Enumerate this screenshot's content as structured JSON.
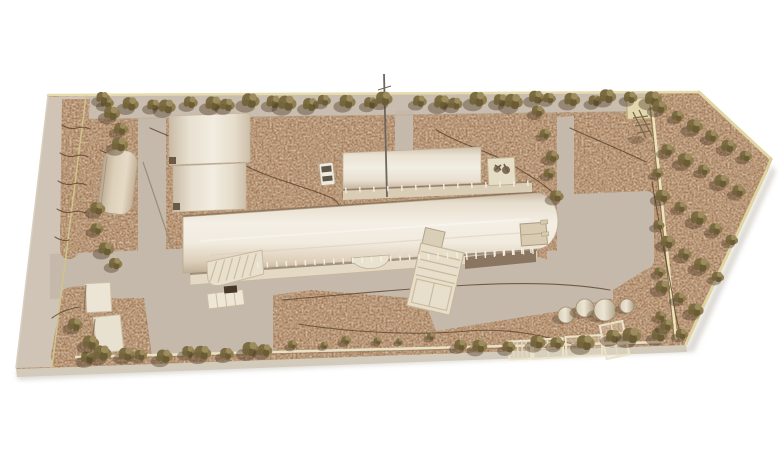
{
  "meta": {
    "title": "Aerial photograph of an architectural site scale model",
    "model_type": "physical scale model: speckled cork site base, pale wood buildings, foam foliage trees",
    "background": "#ffffff"
  },
  "palette": {
    "cork": "#a6764d",
    "pavement": "#c5b9ab",
    "outer_road": "#cfc4b5",
    "north_strip": "#c8bdae",
    "building_cream": "#f2ede1",
    "building_shadow": "#c9baa4",
    "wood_edge": "#e6dcae",
    "tree_olive": "#8a7a4e",
    "tree_dark": "#5f4f2e",
    "contour_line": "#5c432b"
  },
  "site": {
    "shape": "elongated polygon pointed at the right end, bordered by thin wood edge strips",
    "buildings_count": 8,
    "tree_count_approx": 95
  },
  "trees": {
    "rows": [
      [
        112,
        105,
        388,
        101,
        15,
        1.05,
        1.5
      ],
      [
        420,
        102,
        650,
        97,
        13,
        1.0,
        1.5
      ],
      [
        106,
        100,
        122,
        142,
        4,
        1.0,
        1.35
      ],
      [
        96,
        210,
        113,
        266,
        4,
        1.05,
        1.4
      ],
      [
        542,
        112,
        556,
        196,
        5,
        0.85,
        1.15
      ],
      [
        84,
        356,
        268,
        351,
        10,
        1.0,
        1.5
      ],
      [
        292,
        344,
        432,
        339,
        6,
        0.55,
        0.8
      ],
      [
        458,
        346,
        560,
        343,
        5,
        1.0,
        1.3
      ],
      [
        585,
        341,
        658,
        334,
        4,
        1.05,
        1.5
      ],
      [
        80,
        322,
        92,
        344,
        2,
        1.2,
        1.4
      ]
    ],
    "scatter": [
      [
        660,
        107,
        1.2
      ],
      [
        678,
        116,
        1.0
      ],
      [
        695,
        126,
        1.3
      ],
      [
        712,
        136,
        1.1
      ],
      [
        729,
        146,
        1.2
      ],
      [
        746,
        156,
        1.0
      ],
      [
        668,
        150,
        1.1
      ],
      [
        686,
        160,
        1.3
      ],
      [
        704,
        170,
        1.0
      ],
      [
        722,
        181,
        1.2
      ],
      [
        739,
        191,
        1.1
      ],
      [
        663,
        196,
        1.2
      ],
      [
        681,
        207,
        1.0
      ],
      [
        699,
        218,
        1.3
      ],
      [
        716,
        229,
        1.1
      ],
      [
        732,
        240,
        1.0
      ],
      [
        668,
        242,
        1.2
      ],
      [
        685,
        254,
        1.1
      ],
      [
        702,
        265,
        1.3
      ],
      [
        718,
        277,
        1.0
      ],
      [
        663,
        287,
        1.2
      ],
      [
        680,
        298,
        1.0
      ],
      [
        696,
        310,
        1.25
      ],
      [
        667,
        325,
        1.1
      ],
      [
        682,
        334,
        1.0
      ],
      [
        658,
        173,
        0.9
      ],
      [
        659,
        225,
        0.9
      ],
      [
        660,
        272,
        0.9
      ],
      [
        661,
        316,
        0.9
      ]
    ]
  },
  "cylinders": [
    [
      566,
      315,
      8
    ],
    [
      585,
      308,
      9
    ],
    [
      605,
      310,
      11
    ],
    [
      627,
      306,
      7
    ]
  ],
  "planters": [
    [
      509,
      341,
      22,
      18,
      -3,
      5,
      1
    ],
    [
      533,
      339,
      30,
      19,
      -3,
      2,
      2
    ],
    [
      566,
      336,
      36,
      20,
      -3,
      2,
      1
    ],
    [
      603,
      323,
      23,
      34,
      -12,
      2,
      3
    ]
  ],
  "post_rows": [
    [
      258,
      267,
      533,
      253,
      30
    ],
    [
      346,
      192,
      528,
      185,
      14
    ],
    [
      467,
      259,
      531,
      252,
      8
    ]
  ],
  "contours": [
    "M150,128 C190,146 218,152 246,166 C274,180 304,186 332,198 C338,201 340,206 341,212",
    "M436,130 C468,148 492,152 514,166 C530,176 544,184 552,192",
    "M570,128 C596,140 622,150 646,162",
    "M652,182 C658,216 664,252 672,292 C674,308 677,322 680,332",
    "M282,300 C340,295 412,288 470,285 C528,282 576,284 610,290",
    "M298,324 C348,332 414,336 468,331 C506,328 540,334 572,344",
    "M62,125 q8,5 15,3 q7,-2 13,1",
    "M60,153 q8,5 15,3 q7,-2 13,1",
    "M58,181 q8,5 15,3 q7,-2 13,1",
    "M57,209 q8,5 15,3 q7,-2 13,1",
    "M55,237 q8,5 14,3",
    "M52,318 q12,-9 28,-11",
    "M100,150 q10,6 20,5"
  ]
}
